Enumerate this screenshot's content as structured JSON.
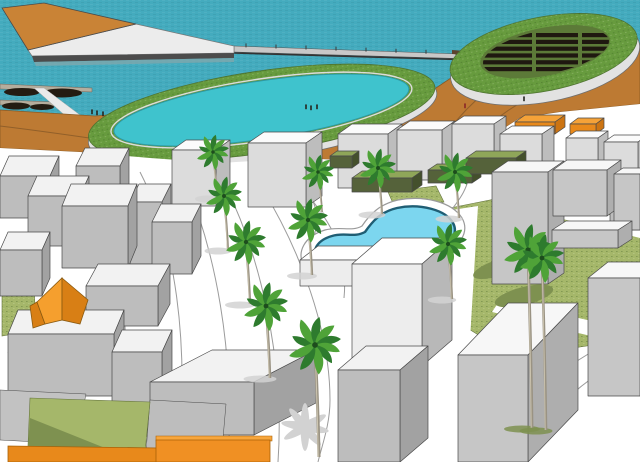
{
  "meta": {
    "description": "3D architectural massing render of a waterfront development: sea with breakwater pier and marina, two elliptical green-roof structures (one with dark panel rows, one enclosing a turquoise lagoon), orange coastal terrain, white block buildings, olive lawns, palm trees and a freeform blue swimming pool."
  },
  "colors": {
    "water": "#44abbe",
    "lagoon": "#3fc3cd",
    "poolWater": "#7cd6ef",
    "poolEdge": "#1f5e74",
    "grassRim": "#679b3e",
    "lawn": "#a5b76a",
    "lawnDark": "#7e9150",
    "lawnEdge": "#66753f",
    "terrain": "#bd7a33",
    "terrainDark": "#8a5a28",
    "breakDeck": "#c98336",
    "ovalWall": "#e2e2e2",
    "ground": "#ffffff",
    "panel": "#1f1810",
    "treeDark": "#2e7b2e",
    "treeLight": "#4fa338",
    "trunk": "#9a9383",
    "pathLine": "#9b9b9b",
    "shadow": "#d2d2d2",
    "outline": "#4a4a4a"
  },
  "palettes": {
    "w": {
      "t": "#f7f7f7",
      "f": "#c6c6c6",
      "s": "#aeaeae"
    },
    "W": {
      "t": "#fbfbfb",
      "f": "#dcdcdc",
      "s": "#bdbdbd"
    },
    "g": {
      "t": "#f2f2f2",
      "f": "#bdbdbd",
      "s": "#a2a2a2"
    },
    "b": {
      "t": "#ffffff",
      "f": "#ededed",
      "s": "#b8b8b8"
    },
    "o": {
      "t": "#f5a238",
      "f": "#e8891b",
      "s": "#cc7412"
    },
    "G": {
      "t": "#8fa659",
      "f": "#55623a",
      "s": "#44502c"
    }
  },
  "scene": {
    "lawns": [
      "415,260 430,225 450,208 520,194 575,200 640,214 640,338 560,350 480,336 432,306",
      "2,290 34,284 36,330 2,336",
      "140,368 152,370 150,437 140,435",
      "455,148 530,142 536,160 458,166",
      "388,192 436,186 444,202 396,210"
    ],
    "whiteBands": [
      "535,198 640,222 640,238 526,210",
      "500,300 640,332 640,348 492,312",
      "452,210 478,206 470,340 444,334"
    ],
    "plazaPaths": [
      "M88,162 C120,220 135,330 120,462",
      "M140,172 C175,240 190,340 178,462",
      "M185,180 C215,250 235,350 228,462",
      "M225,185 C260,255 285,360 278,462",
      "M262,188 C300,250 330,330 330,400 C330,425 322,445 318,462",
      "M300,186 C336,226 348,256 344,298",
      "M305,190 C328,214 312,248 300,264",
      "M470,163 C472,196 444,214 432,236",
      "M640,330 C560,360 520,400 505,462",
      "M640,352 C575,380 540,420 528,462",
      "M8,352 C28,386 34,420 30,462"
    ],
    "terrainPaths": [
      "M428,160 C452,122 478,92 518,70",
      "M452,168 C478,132 505,106 548,90",
      "M0,126 C50,132 90,138 130,144"
    ],
    "panels": {
      "y0": 33,
      "step": 6.8,
      "h": 4.2,
      "rows": 6,
      "groups": [
        [
          482,
          50
        ],
        [
          536,
          42
        ],
        [
          582,
          32
        ]
      ]
    },
    "buildings": [
      {
        "x": 172,
        "y": 150,
        "w": 44,
        "h": 56,
        "dx": 14,
        "dy": 10,
        "k": "W"
      },
      {
        "x": 248,
        "y": 143,
        "w": 58,
        "h": 64,
        "dx": 16,
        "dy": 11,
        "k": "W"
      },
      {
        "x": 338,
        "y": 134,
        "w": 50,
        "h": 54,
        "dx": 14,
        "dy": 10,
        "k": "W"
      },
      {
        "x": 397,
        "y": 130,
        "w": 45,
        "h": 50,
        "dx": 13,
        "dy": 9,
        "k": "W"
      },
      {
        "x": 452,
        "y": 124,
        "w": 42,
        "h": 46,
        "dx": 12,
        "dy": 8,
        "k": "W"
      },
      {
        "x": 515,
        "y": 122,
        "w": 40,
        "h": 12,
        "dx": 10,
        "dy": 7,
        "k": "o"
      },
      {
        "x": 570,
        "y": 124,
        "w": 26,
        "h": 10,
        "dx": 8,
        "dy": 6,
        "k": "o"
      },
      {
        "x": 500,
        "y": 134,
        "w": 42,
        "h": 40,
        "dx": 12,
        "dy": 8,
        "k": "W"
      },
      {
        "x": 566,
        "y": 138,
        "w": 32,
        "h": 38,
        "dx": 10,
        "dy": 7,
        "k": "W"
      },
      {
        "x": 604,
        "y": 142,
        "w": 34,
        "h": 44,
        "dx": 10,
        "dy": 7,
        "k": "W"
      },
      {
        "x": 330,
        "y": 156,
        "w": 22,
        "h": 12,
        "dx": 7,
        "dy": 5,
        "k": "G"
      },
      {
        "x": 352,
        "y": 178,
        "w": 60,
        "h": 14,
        "dx": 10,
        "dy": 7,
        "k": "G"
      },
      {
        "x": 428,
        "y": 170,
        "w": 44,
        "h": 13,
        "dx": 9,
        "dy": 6,
        "k": "G"
      },
      {
        "x": 466,
        "y": 158,
        "w": 50,
        "h": 16,
        "dx": 10,
        "dy": 7,
        "k": "G"
      },
      {
        "x": 610,
        "y": 196,
        "w": 30,
        "h": 34,
        "dx": 8,
        "dy": 6,
        "k": "g"
      },
      {
        "x": 492,
        "y": 172,
        "w": 56,
        "h": 112,
        "dx": 16,
        "dy": 11,
        "k": "w"
      },
      {
        "x": 553,
        "y": 170,
        "w": 54,
        "h": 46,
        "dx": 14,
        "dy": 10,
        "k": "w"
      },
      {
        "x": 614,
        "y": 174,
        "w": 26,
        "h": 56,
        "dx": 9,
        "dy": 6,
        "k": "w"
      },
      {
        "x": 552,
        "y": 230,
        "w": 66,
        "h": 18,
        "dx": 14,
        "dy": 9,
        "k": "w"
      },
      {
        "x": 0,
        "y": 176,
        "w": 50,
        "h": 42,
        "dx": 9,
        "dy": 20,
        "k": "g"
      },
      {
        "x": 76,
        "y": 166,
        "w": 44,
        "h": 40,
        "dx": 9,
        "dy": 18,
        "k": "g"
      },
      {
        "x": 28,
        "y": 196,
        "w": 52,
        "h": 50,
        "dx": 9,
        "dy": 20,
        "k": "g"
      },
      {
        "x": 130,
        "y": 202,
        "w": 32,
        "h": 62,
        "dx": 9,
        "dy": 18,
        "k": "g"
      },
      {
        "x": 62,
        "y": 206,
        "w": 66,
        "h": 62,
        "dx": 9,
        "dy": 22,
        "k": "g"
      },
      {
        "x": 152,
        "y": 222,
        "w": 40,
        "h": 52,
        "dx": 9,
        "dy": 18,
        "k": "g"
      },
      {
        "x": 0,
        "y": 250,
        "w": 42,
        "h": 46,
        "dx": 8,
        "dy": 18,
        "k": "g"
      },
      {
        "x": 86,
        "y": 286,
        "w": 72,
        "h": 40,
        "dx": 12,
        "dy": 22,
        "k": "g"
      },
      {
        "x": 300,
        "y": 260,
        "w": 58,
        "h": 26,
        "dx": 18,
        "dy": 14,
        "k": "b"
      },
      {
        "x": 352,
        "y": 264,
        "w": 70,
        "h": 102,
        "dx": 30,
        "dy": 26,
        "k": "b"
      },
      {
        "x": 8,
        "y": 334,
        "w": 106,
        "h": 62,
        "dx": 10,
        "dy": 24,
        "k": "g"
      },
      {
        "x": 112,
        "y": 352,
        "w": 50,
        "h": 80,
        "dx": 10,
        "dy": 22,
        "k": "g"
      },
      {
        "x": 150,
        "y": 382,
        "w": 104,
        "h": 53,
        "dx": 62,
        "dy": 32,
        "k": "g"
      },
      {
        "x": 338,
        "y": 370,
        "w": 62,
        "h": 92,
        "dx": 28,
        "dy": 24,
        "k": "g"
      },
      {
        "x": 458,
        "y": 355,
        "w": 70,
        "h": 107,
        "dx": 50,
        "dy": 52,
        "k": "w"
      },
      {
        "x": 588,
        "y": 278,
        "w": 52,
        "h": 118,
        "dx": 20,
        "dy": 16,
        "k": "w"
      }
    ],
    "palms": [
      {
        "x": 213,
        "y": 152,
        "s": 0.8,
        "t": 46
      },
      {
        "x": 224,
        "y": 196,
        "s": 0.9,
        "t": 54
      },
      {
        "x": 246,
        "y": 242,
        "s": 1.0,
        "t": 62
      },
      {
        "x": 266,
        "y": 306,
        "s": 1.1,
        "t": 72
      },
      {
        "x": 318,
        "y": 172,
        "s": 0.8,
        "t": 40
      },
      {
        "x": 308,
        "y": 220,
        "s": 1.0,
        "t": 55
      },
      {
        "x": 378,
        "y": 168,
        "s": 0.9,
        "t": 46
      },
      {
        "x": 455,
        "y": 172,
        "s": 0.9,
        "t": 46
      },
      {
        "x": 448,
        "y": 244,
        "s": 0.95,
        "t": 55
      },
      {
        "x": 315,
        "y": 345,
        "s": 1.3,
        "t": 112,
        "big": true
      },
      {
        "x": 528,
        "y": 250,
        "s": 1.2,
        "t": 178,
        "dk": true
      },
      {
        "x": 542,
        "y": 258,
        "s": 1.1,
        "t": 172,
        "dk": true
      }
    ],
    "people": [
      [
        92,
        114
      ],
      [
        97,
        115
      ],
      [
        103,
        116
      ],
      [
        306,
        109
      ],
      [
        311,
        110
      ],
      [
        317,
        109
      ],
      [
        465,
        108,
        "#8a2727"
      ],
      [
        524,
        101
      ]
    ]
  }
}
